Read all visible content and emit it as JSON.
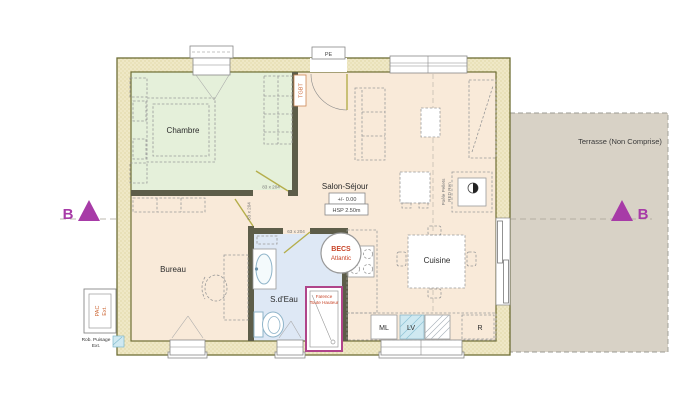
{
  "rooms": {
    "chambre": "Chambre",
    "bureau": "Bureau",
    "sdeau": "S.d'Eau",
    "salon": "Salon-Séjour",
    "cuisine": "Cuisine",
    "terrasse": "Terrasse (Non Comprise)"
  },
  "levels": {
    "altitude": "+/- 0.00",
    "ceiling_height": "HSP 2.50m"
  },
  "doors": {
    "chambre": "83 x 204",
    "bureau": "83 x 204",
    "sdeau": "63 x 204"
  },
  "equipment": {
    "entry_door": "PE",
    "electrical_panel": "TGBT",
    "water_heater": [
      "BECS",
      "Atlantic"
    ],
    "shower_tiling": [
      "Faïence",
      "Toute Hauteur"
    ],
    "pellet_stove": [
      "Poêle Pellets",
      "RED Ren"
    ],
    "heat_pump": [
      "PAC",
      "Ext."
    ],
    "outdoor_tap": [
      "Rob. Puisage",
      "Ext."
    ],
    "washing_machine": "ML",
    "dishwasher": "LV",
    "fridge": "R"
  },
  "section": {
    "letter": "B"
  },
  "colors": {
    "wall_fill": "#efe8c6",
    "wall_line": "#6e6e35",
    "partition": "#5d5d49",
    "chambre_fill": "#e5f0da",
    "floor_fill": "#f9ead9",
    "sdeau_fill": "#dee8f5",
    "terrasse_fill": "#d8d2c6",
    "section_marker": "#a73ba7",
    "equipment_red": "#c84326",
    "shower_border": "#b0458a",
    "dishwasher_fill": "#cfe9f1",
    "door_leaf": "#b5ae4c"
  }
}
